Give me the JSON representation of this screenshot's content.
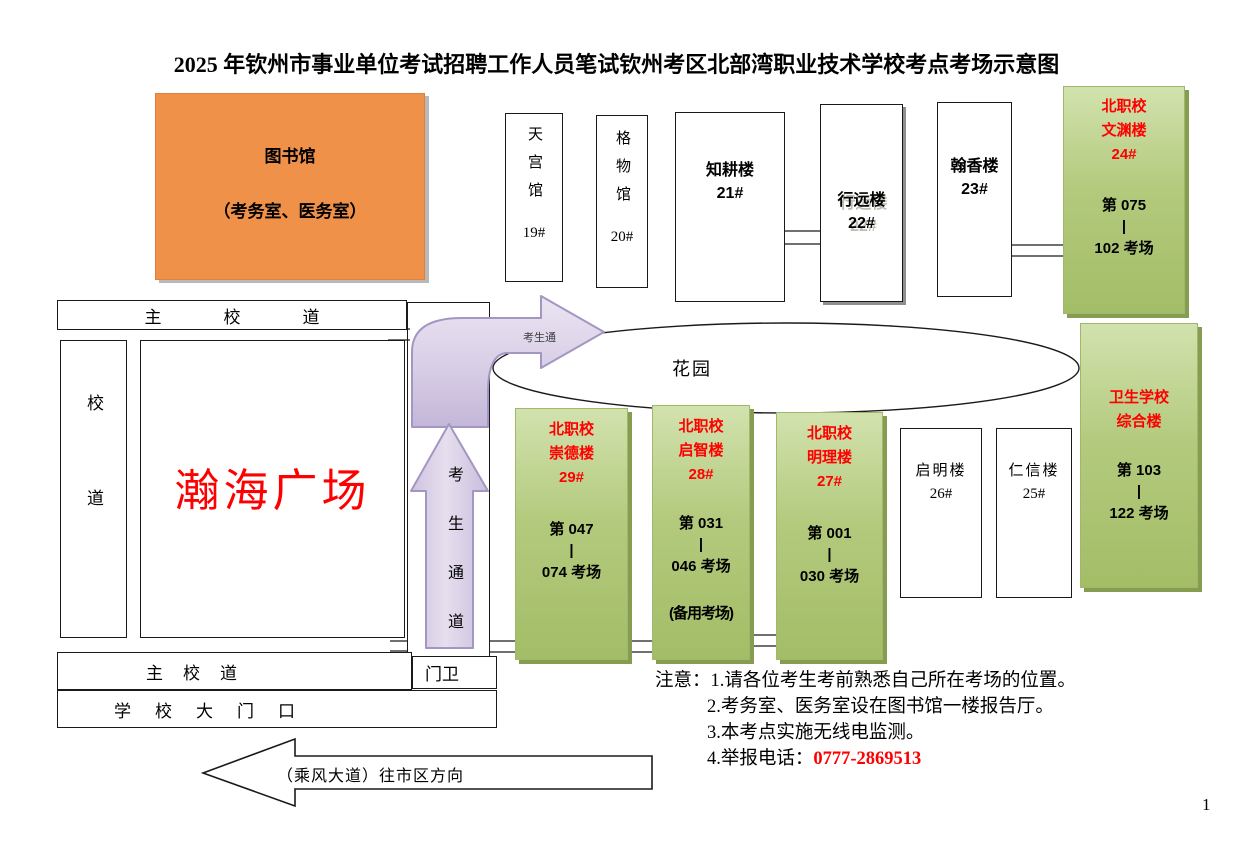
{
  "title": "2025 年钦州市事业单位考试招聘工作人员笔试钦州考区北部湾职业技术学校考点考场示意图",
  "page_number": "1",
  "library": {
    "name": "图书馆",
    "subtitle": "（考务室、医务室）"
  },
  "roads": {
    "main_road_top": "主校道",
    "main_road_bottom": "主校道",
    "side_road": "校道",
    "school_gate": "学校大门口",
    "guard_post": "门卫",
    "plaza": "瀚海广场",
    "garden": "花园"
  },
  "walkway": {
    "horizontal_label": "考生通",
    "vertical_label": "考生通道"
  },
  "street_arrow_label": "（乘风大道）往市区方向",
  "buildings": {
    "tiangong": {
      "name": "天宫馆",
      "number": "19#"
    },
    "gewu": {
      "name": "格物馆",
      "number": "20#"
    },
    "zhigeng": {
      "name": "知耕楼",
      "number": "21#"
    },
    "xingyuan": {
      "name": "行远楼",
      "number": "22#"
    },
    "hanxiang": {
      "name": "翰香楼",
      "number": "23#"
    },
    "qiming": {
      "name": "启明楼",
      "number": "26#"
    },
    "renxin": {
      "name": "仁信楼",
      "number": "25#"
    }
  },
  "exam_buildings": {
    "wenyuan": {
      "school": "北职校",
      "name": "文渊楼",
      "number": "24#",
      "room_from": "第 075",
      "sep": "|",
      "room_to": "102 考场"
    },
    "chongde": {
      "school": "北职校",
      "name": "崇德楼",
      "number": "29#",
      "room_from": "第 047",
      "sep": "|",
      "room_to": "074 考场"
    },
    "qizhi": {
      "school": "北职校",
      "name": "启智楼",
      "number": "28#",
      "room_from": "第 031",
      "sep": "|",
      "room_to": "046 考场",
      "backup": "(备用考场)"
    },
    "mingli": {
      "school": "北职校",
      "name": "明理楼",
      "number": "27#",
      "room_from": "第 001",
      "sep": "|",
      "room_to": "030 考场"
    },
    "weisheng": {
      "school": "卫生学校",
      "name": "综合楼",
      "room_from": "第 103",
      "sep": "|",
      "room_to": "122 考场"
    }
  },
  "notes": {
    "label": "注意：",
    "item1": "1.请各位考生考前熟悉自己所在考场的位置。",
    "item2": "2.考务室、医务室设在图书馆一楼报告厅。",
    "item3": "3.本考点实施无线电监测。",
    "item4_prefix": "4.举报电话：",
    "phone": "0777-2869513"
  },
  "colors": {
    "accent_red": "#ff0000",
    "exam_green_top": "#d2e2ae",
    "exam_green_bottom": "#a3bd67",
    "library_orange": "#f0914a",
    "walkway_purple": "#cfc3e0"
  }
}
